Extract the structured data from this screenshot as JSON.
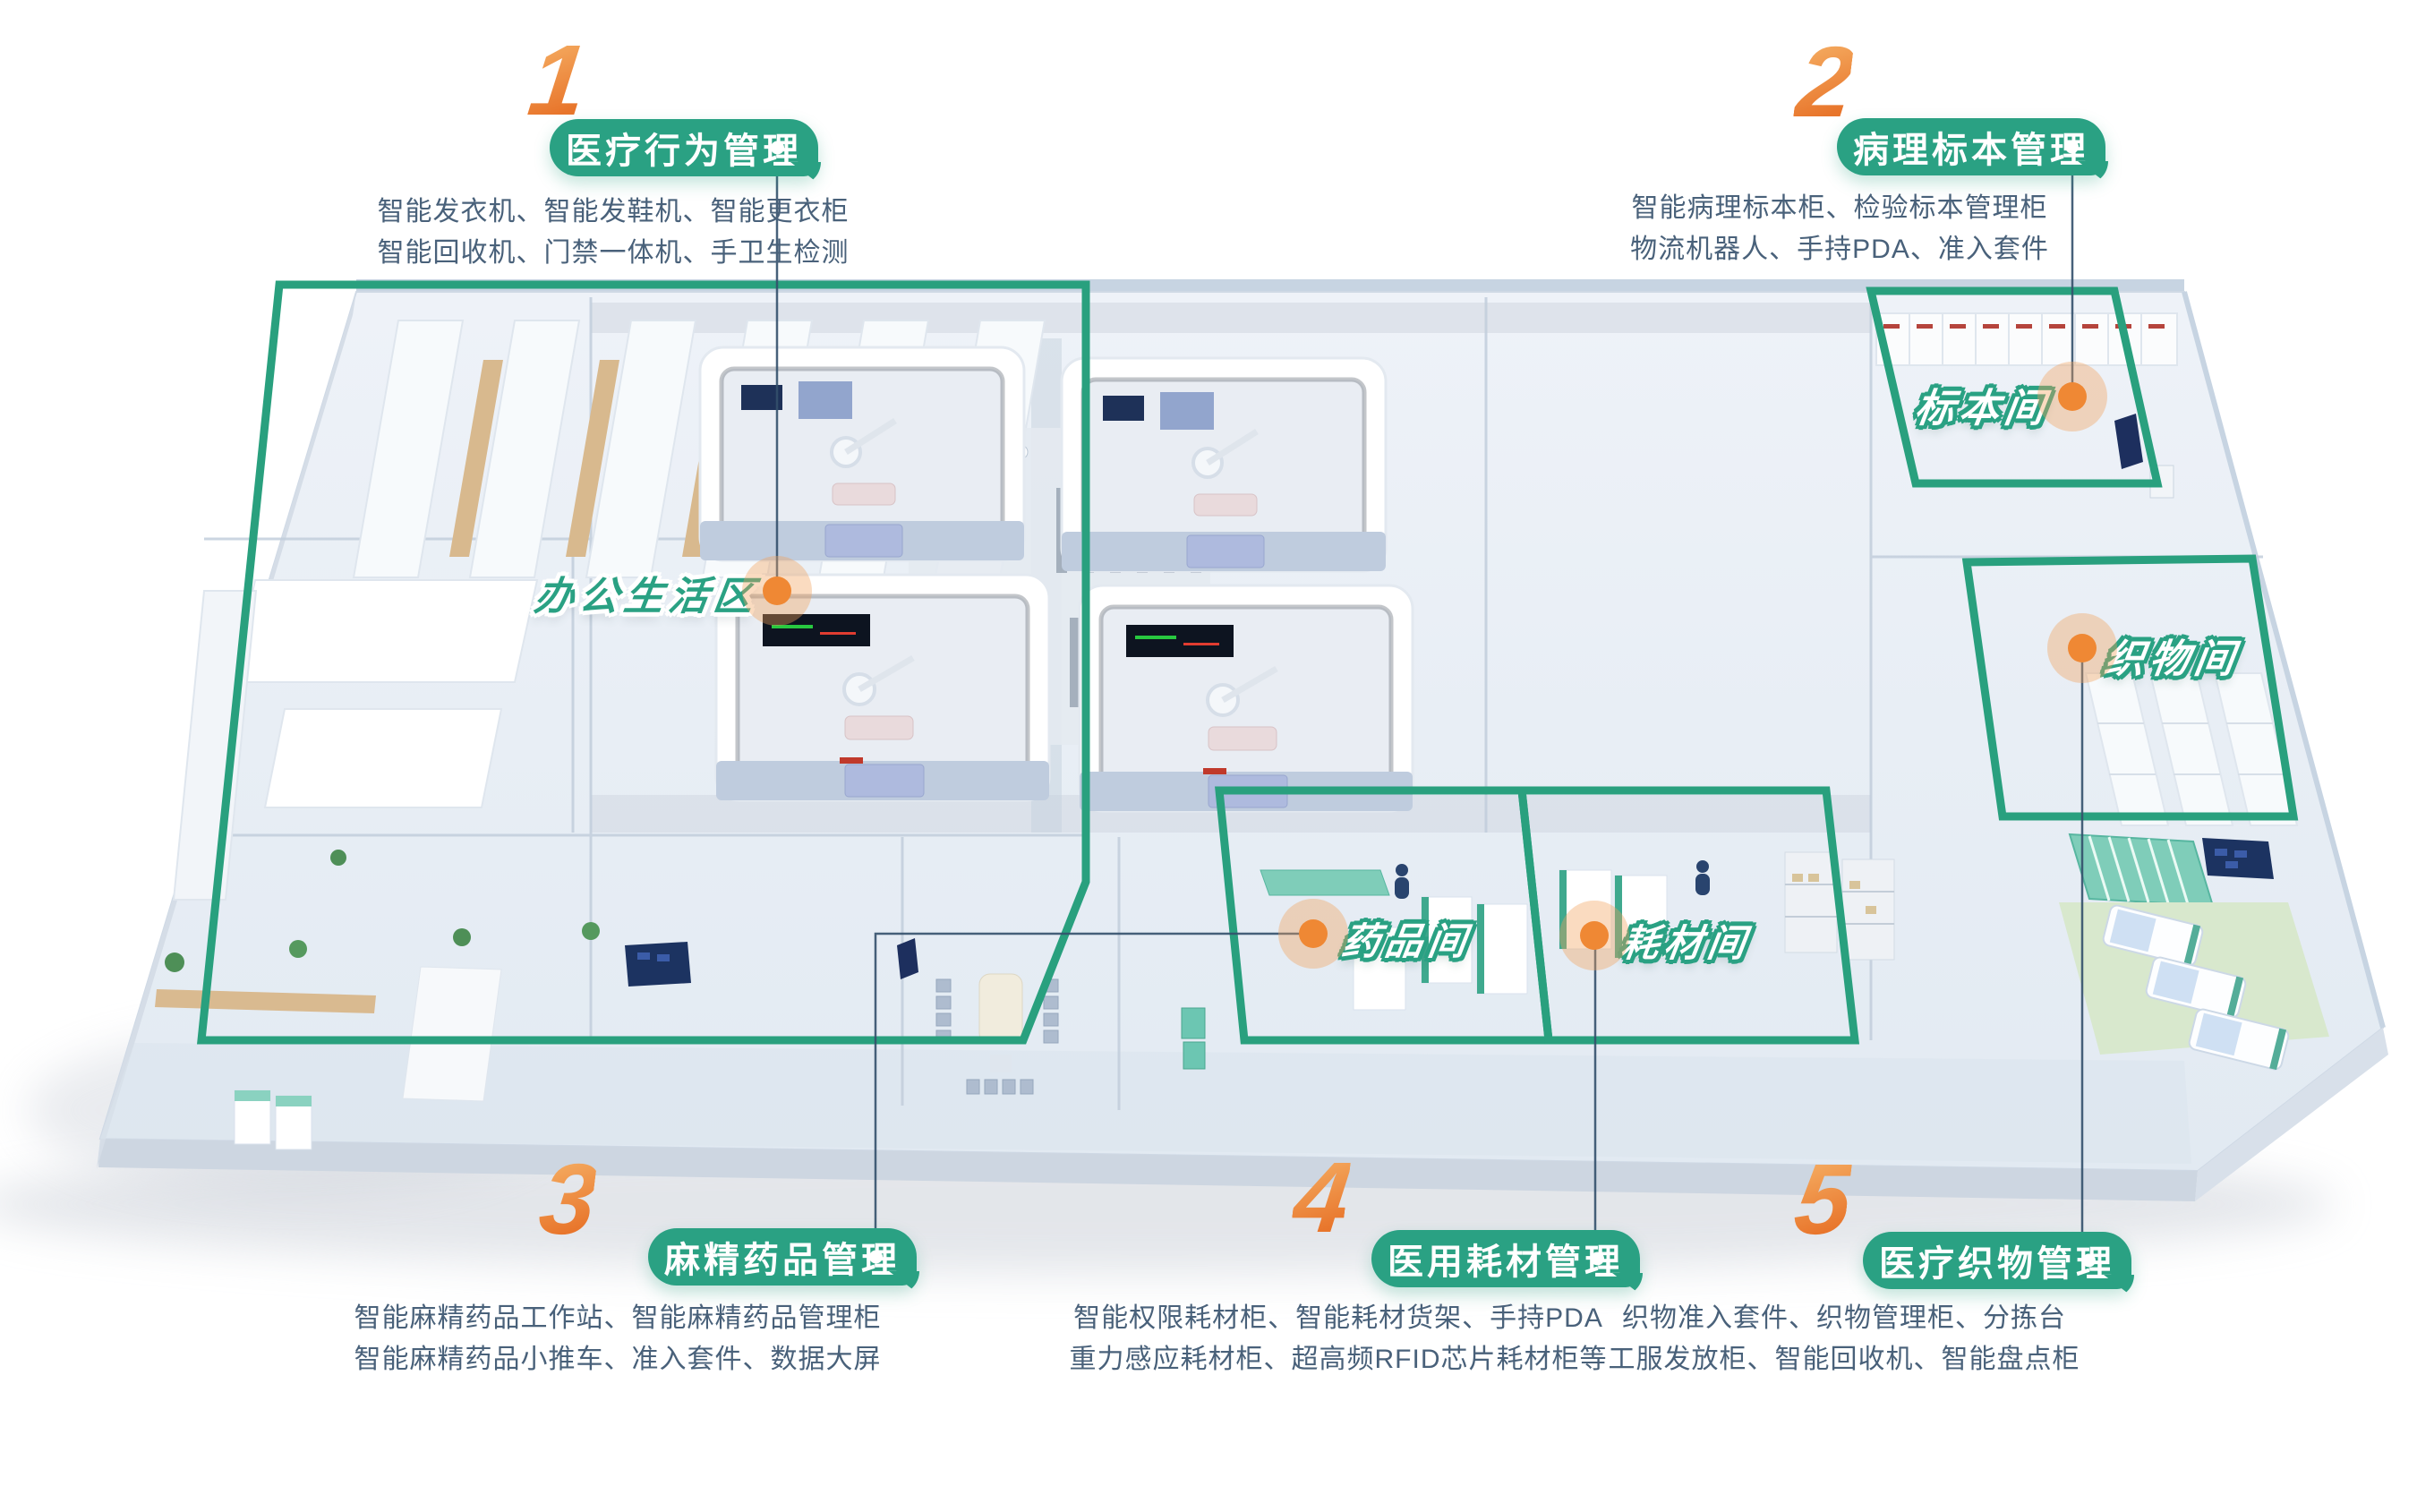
{
  "poster": {
    "theme": "smart hospital floorplan infographic",
    "colors": {
      "brand_green": "#2AA183",
      "accent_orange": "#ED7A1E",
      "number_gradient_top": "#F6B267",
      "number_gradient_bottom": "#E8752B",
      "description_text": "#49617A",
      "connector_line": "#33506B"
    }
  },
  "legend": [
    {
      "number": "1",
      "title": "医疗行为管理",
      "lines": [
        "智能发衣机、智能发鞋机、智能更衣柜",
        "智能回收机、门禁一体机、手卫生检测"
      ]
    },
    {
      "number": "2",
      "title": "病理标本管理",
      "lines": [
        "智能病理标本柜、检验标本管理柜",
        "物流机器人、手持PDA、准入套件"
      ]
    },
    {
      "number": "3",
      "title": "麻精药品管理",
      "lines": [
        "智能麻精药品工作站、智能麻精药品管理柜",
        "智能麻精药品小推车、准入套件、数据大屏"
      ]
    },
    {
      "number": "4",
      "title": "医用耗材管理",
      "lines": [
        "智能权限耗材柜、智能耗材货架、手持PDA",
        "重力感应耗材柜、超高频RFID芯片耗材柜等"
      ]
    },
    {
      "number": "5",
      "title": "医疗织物管理",
      "lines": [
        "织物准入套件、织物管理柜、分拣台",
        "工服发放柜、智能回收机、智能盘点柜"
      ]
    }
  ],
  "rooms": [
    {
      "id": "office",
      "label": "办公生活区"
    },
    {
      "id": "specimen",
      "label": "标本间"
    },
    {
      "id": "textile",
      "label": "织物间"
    },
    {
      "id": "pharmacy",
      "label": "药品间"
    },
    {
      "id": "consumable",
      "label": "耗材间"
    }
  ]
}
